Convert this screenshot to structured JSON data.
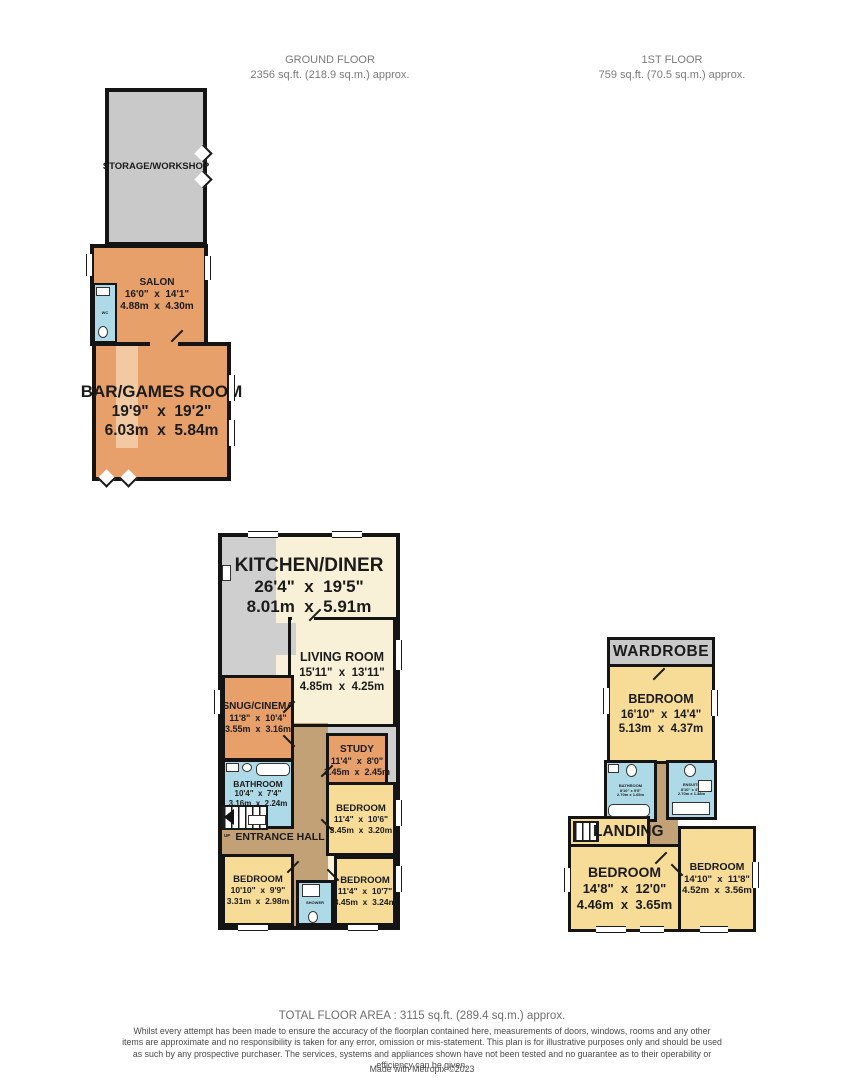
{
  "header": {
    "ground_floor_label": "GROUND FLOOR",
    "ground_floor_area": "2356 sq.ft. (218.9 sq.m.) approx.",
    "first_floor_label": "1ST FLOOR",
    "first_floor_area": "759 sq.ft. (70.5 sq.m.) approx."
  },
  "annex": {
    "storage": {
      "name": "STORAGE/WORKSHOP"
    },
    "salon": {
      "name": "SALON",
      "imperial": "16'0\"  x  14'1\"",
      "metric": "4.88m  x  4.30m"
    },
    "salon_wc": {
      "name": "WC"
    },
    "bar": {
      "name": "BAR/GAMES ROOM",
      "imperial": "19'9\"  x  19'2\"",
      "metric": "6.03m  x  5.84m"
    }
  },
  "main": {
    "kitchen": {
      "name": "KITCHEN/DINER",
      "imperial": "26'4\"  x  19'5\"",
      "metric": "8.01m  x  5.91m"
    },
    "living": {
      "name": "LIVING ROOM",
      "imperial": "15'11\"  x  13'11\"",
      "metric": "4.85m  x  4.25m"
    },
    "snug": {
      "name": "SNUG/CINEMA",
      "imperial": "11'8\"  x  10'4\"",
      "metric": "3.55m  x  3.16m"
    },
    "study": {
      "name": "STUDY",
      "imperial": "11'4\"  x  8'0\"",
      "metric": "3.45m  x  2.45m"
    },
    "bathroom": {
      "name": "BATHROOM",
      "imperial": "10'4\"  x  7'4\"",
      "metric": "3.16m  x  2.24m"
    },
    "hall": {
      "name": "ENTRANCE HALL",
      "up": "UP"
    },
    "bedroom_right": {
      "name": "BEDROOM",
      "imperial": "11'4\"  x  10'6\"",
      "metric": "3.45m  x  3.20m"
    },
    "bedroom_left": {
      "name": "BEDROOM",
      "imperial": "10'10\"  x  9'9\"",
      "metric": "3.31m  x  2.98m"
    },
    "bedroom_bottom": {
      "name": "BEDROOM",
      "imperial": "11'4\"  x  10'7\"",
      "metric": "3.45m  x  3.24m"
    },
    "shower": {
      "name": "SHOWER"
    }
  },
  "first": {
    "wardrobe": {
      "name": "WARDROBE"
    },
    "bedroom_main": {
      "name": "BEDROOM",
      "imperial": "16'10\"  x  14'4\"",
      "metric": "5.13m  x  4.37m"
    },
    "bathroom": {
      "name": "BATHROOM",
      "imperial": "8'10\" x 5'5\"",
      "metric": "2.70m x 1.65m"
    },
    "ensuite": {
      "name": "ENSUITE",
      "imperial": "8'10\" x 4'6\"",
      "metric": "2.70m x 1.38m"
    },
    "landing": {
      "name": "LANDING"
    },
    "bedroom_left": {
      "name": "BEDROOM",
      "imperial": "14'8\"  x  12'0\"",
      "metric": "4.46m  x  3.65m"
    },
    "bedroom_right": {
      "name": "BEDROOM",
      "imperial": "14'10\"  x  11'8\"",
      "metric": "4.52m  x  3.56m"
    }
  },
  "footer": {
    "total": "TOTAL FLOOR AREA : 3115 sq.ft. (289.4 sq.m.) approx.",
    "disclaimer": "Whilst every attempt has been made to ensure the accuracy of the floorplan contained here, measurements of doors, windows, rooms and any other items are approximate and no responsibility is taken for any error, omission or mis-statement. This plan is for illustrative purposes only and should be used as such by any prospective purchaser. The services, systems and appliances shown have not been tested and no guarantee as to their operability or efficiency can be given.",
    "credit": "Made with Metropix ©2023"
  },
  "colors": {
    "wall": "#141414",
    "room_orange": "#e8a06a",
    "room_yellow": "#f6dc96",
    "room_cream": "#f8f1d7",
    "room_blue": "#aedae7",
    "room_gray": "#c9c9c9",
    "hall_brown": "#c2a176"
  }
}
